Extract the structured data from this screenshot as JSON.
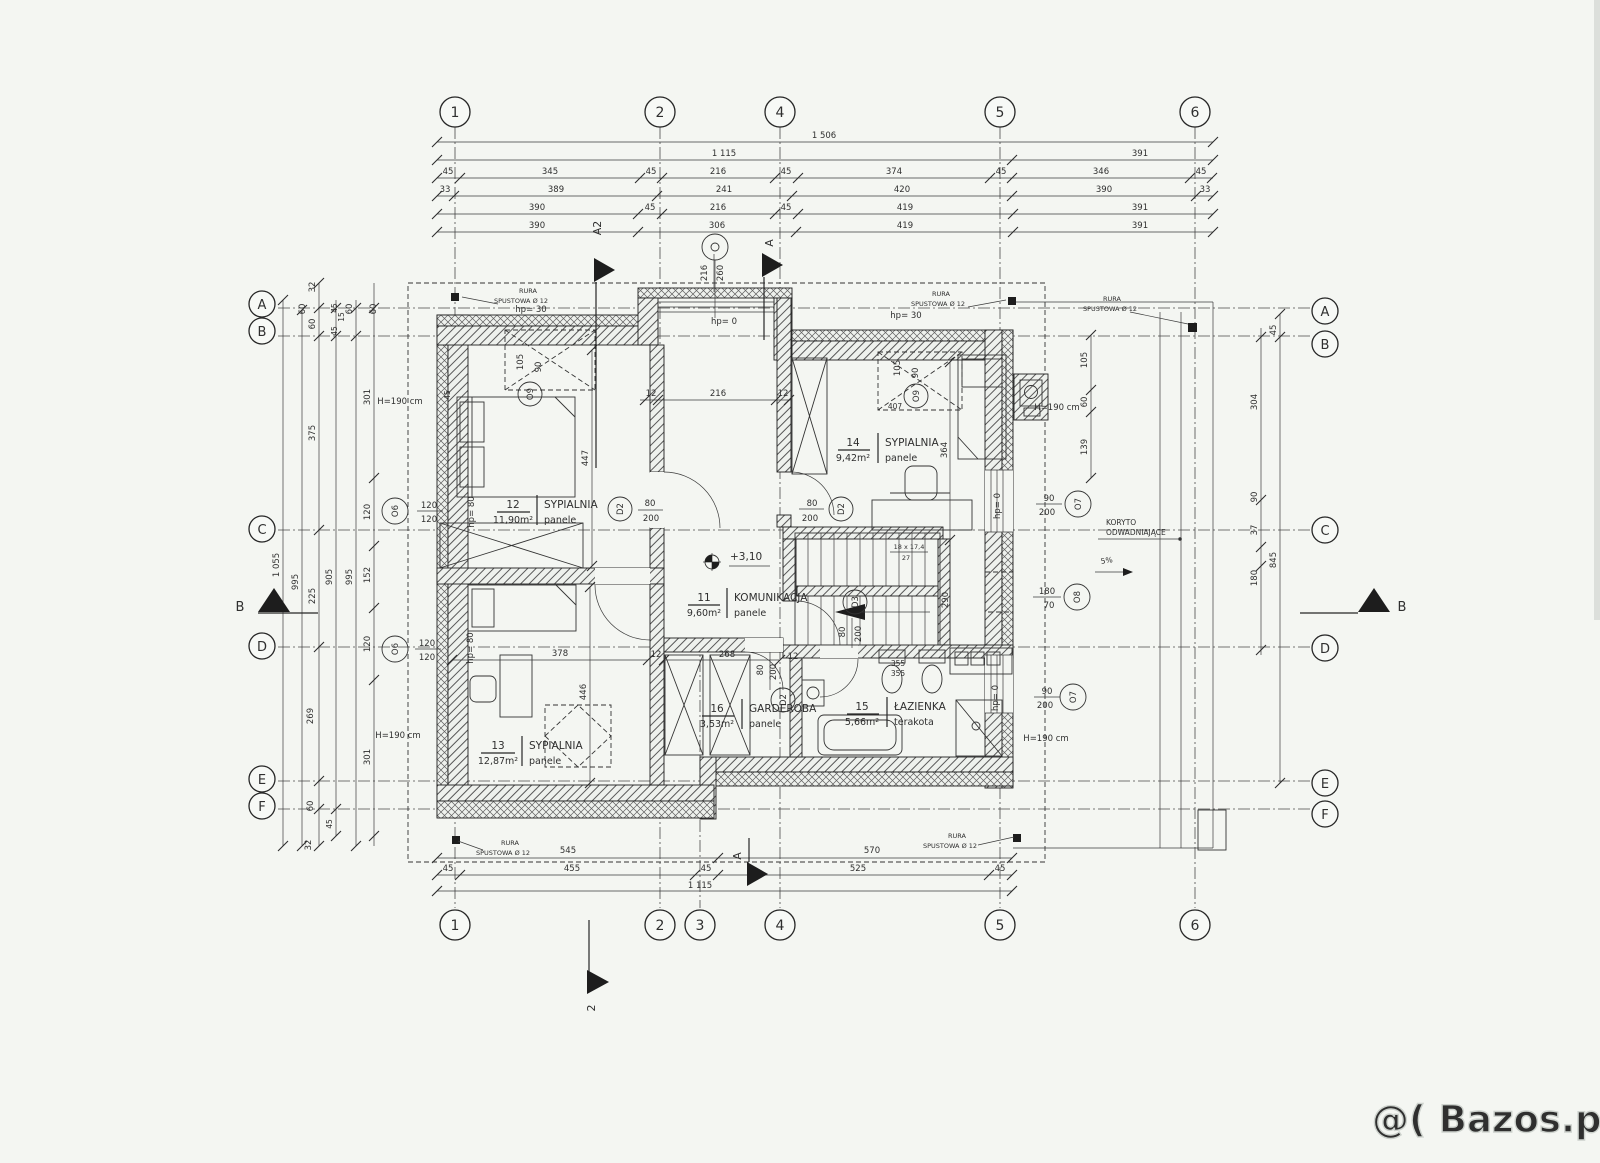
{
  "meta": {
    "paper_color": "#f4f6f2",
    "ink_color": "#2f2f2f",
    "watermark_color": "#cdd2cd"
  },
  "watermark": "@( Bazos.pl",
  "grid": {
    "top": [
      "1",
      "2",
      "4",
      "5",
      "6"
    ],
    "bottom": [
      "1",
      "2",
      "3",
      "4",
      "5",
      "6"
    ],
    "left": [
      "A",
      "B",
      "C",
      "D",
      "E",
      "F"
    ],
    "right": [
      "A",
      "B",
      "C",
      "D",
      "E",
      "F"
    ]
  },
  "sections": {
    "a2": "A2",
    "a": "A",
    "b": "B",
    "two": "2"
  },
  "rooms": {
    "r12": {
      "num": "12",
      "name": "SYPIALNIA",
      "area": "11,90m²",
      "floor": "panele"
    },
    "r14": {
      "num": "14",
      "name": "SYPIALNIA",
      "area": "9,42m²",
      "floor": "panele"
    },
    "r11": {
      "num": "11",
      "name": "KOMUNIKACJA",
      "area": "9,60m²",
      "floor": "panele"
    },
    "r13": {
      "num": "13",
      "name": "SYPIALNIA",
      "area": "12,87m²",
      "floor": "panele"
    },
    "r16": {
      "num": "16",
      "name": "GARDEROBA",
      "area": "3,53m²",
      "floor": "panele"
    },
    "r15": {
      "num": "15",
      "name": "ŁAZIENKA",
      "area": "5,66m²",
      "floor": "terakota"
    }
  },
  "tags": {
    "o9": "O9",
    "o6": "O6",
    "o7": "O7",
    "o8": "O8",
    "d2": "D2",
    "d3": "D3"
  },
  "tag_dims": {
    "o9w": "105",
    "o9h": "90",
    "o6w": "120",
    "o6h": "120",
    "o7w": "90",
    "o7h": "200",
    "o8w": "180",
    "o8h": "70",
    "d2w": "80",
    "d2h": "200",
    "d3w": "80",
    "d3h": "200",
    "ow": "216",
    "oh": "260"
  },
  "ann": {
    "rura": "RURA",
    "spust": "SPUSTOWA Ø 12",
    "koryto1": "KORYTO",
    "koryto2": "ODWADNIAJĄCE",
    "h190": "H=190 cm",
    "hp30": "hp= 30",
    "hp0": "hp= 0",
    "hp80": "hp= 80",
    "level": "+3,10",
    "slope": "5%",
    "stairs": "18 x 17,4",
    "stairs2": "27",
    "n355": "355",
    "n407": "407",
    "n45": "45"
  },
  "dims": {
    "t1": [
      "1 506"
    ],
    "t2": [
      "1 115",
      "391"
    ],
    "t3": [
      "45",
      "345",
      "45",
      "216",
      "45",
      "374",
      "45",
      "346",
      "45"
    ],
    "t4": [
      "33",
      "389",
      "241",
      "420",
      "390",
      "33"
    ],
    "t5": [
      "390",
      "45",
      "216",
      "45",
      "419",
      "391"
    ],
    "t6": [
      "390",
      "306",
      "419",
      "391"
    ],
    "b1": [
      "545",
      "570"
    ],
    "b2": [
      "45",
      "455",
      "45",
      "525",
      "45"
    ],
    "b3": [
      "1 115"
    ],
    "left": [
      "32",
      "60",
      "60",
      "45",
      "15",
      "45",
      "60",
      "60",
      "375",
      "301",
      "120",
      "1 055",
      "995",
      "225",
      "905",
      "995",
      "152",
      "120",
      "269",
      "301",
      "60",
      "45",
      "32"
    ],
    "right": [
      "45",
      "304",
      "90",
      "37",
      "845",
      "180",
      "105",
      "60",
      "139"
    ],
    "inner": [
      "12",
      "216",
      "12",
      "447",
      "446",
      "378",
      "12",
      "268",
      "12",
      "355",
      "364",
      "290"
    ]
  }
}
